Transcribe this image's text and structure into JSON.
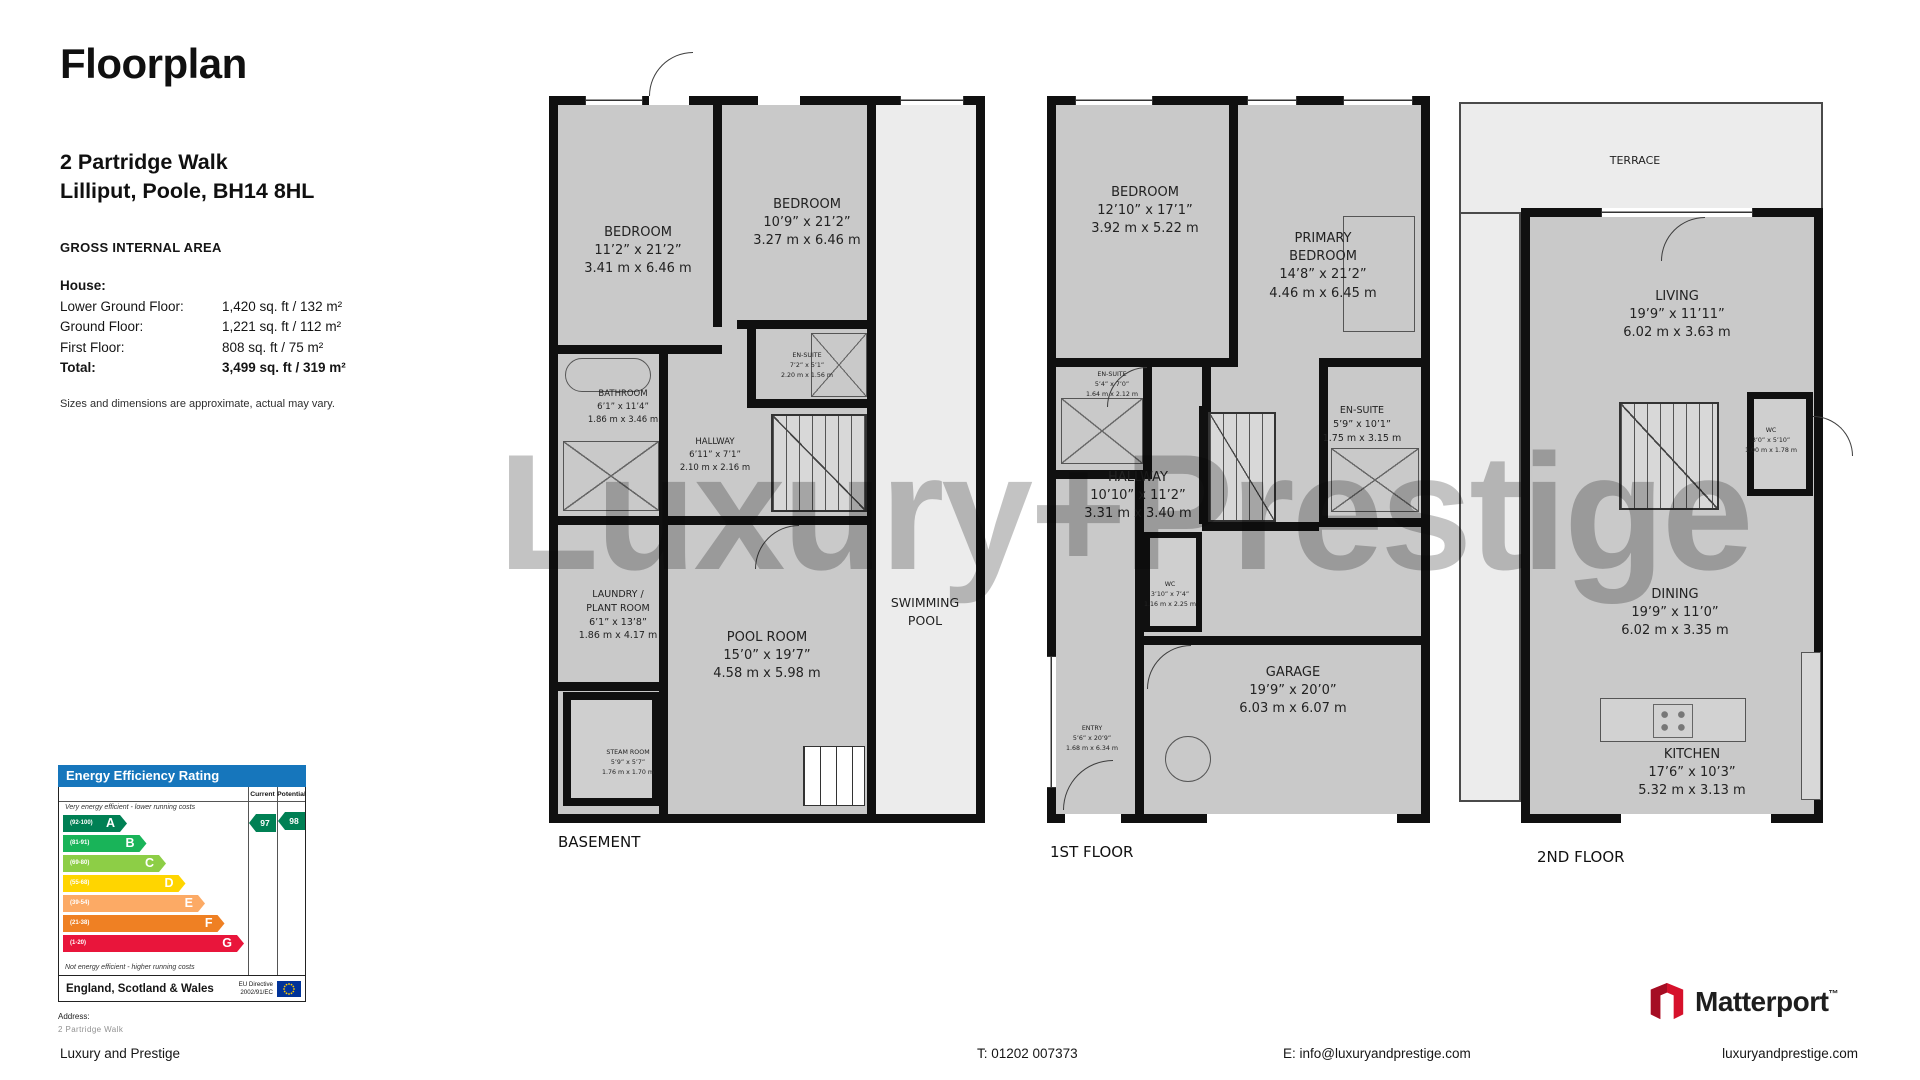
{
  "header": {
    "title": "Floorplan",
    "address_line1": "2 Partridge Walk",
    "address_line2": "Lilliput, Poole, BH14 8HL"
  },
  "gia": {
    "heading": "GROSS INTERNAL AREA",
    "rows": [
      {
        "label": "House:",
        "value": ""
      },
      {
        "label": "Lower Ground Floor:",
        "value": "1,420 sq. ft / 132 m²"
      },
      {
        "label": "Ground Floor:",
        "value": "1,221 sq. ft / 112 m²"
      },
      {
        "label": "First Floor:",
        "value": "808 sq. ft / 75 m²"
      },
      {
        "label": "Total:",
        "value": "3,499 sq. ft / 319 m²"
      }
    ],
    "disclaimer": "Sizes and dimensions are approximate, actual may vary."
  },
  "watermark": "Luxury+Prestige",
  "floors": {
    "basement": {
      "label": "BASEMENT",
      "rooms": {
        "bedroom1": {
          "name": "BEDROOM",
          "imperial": "11’2” x 21’2”",
          "metric": "3.41 m x 6.46 m"
        },
        "bedroom2": {
          "name": "BEDROOM",
          "imperial": "10’9” x 21’2”",
          "metric": "3.27 m x 6.46 m"
        },
        "bathroom": {
          "name": "BATHROOM",
          "imperial": "6’1” x 11’4”",
          "metric": "1.86 m x 3.46 m"
        },
        "hallway": {
          "name": "HALLWAY",
          "imperial": "6’11” x 7’1”",
          "metric": "2.10 m x 2.16 m"
        },
        "ensuite": {
          "name": "EN-SUITE",
          "imperial": "7’2” x 5’1”",
          "metric": "2.20 m x 1.56 m"
        },
        "laundry": {
          "name": "LAUNDRY /\nPLANT ROOM",
          "imperial": "6’1” x 13’8”",
          "metric": "1.86 m x 4.17 m"
        },
        "pool_room": {
          "name": "POOL ROOM",
          "imperial": "15’0” x 19’7”",
          "metric": "4.58 m x 5.98 m"
        },
        "steam_room": {
          "name": "STEAM ROOM",
          "imperial": "5’9” x 5’7”",
          "metric": "1.76 m x 1.70 m"
        },
        "swimming_pool": {
          "name": "SWIMMING\nPOOL"
        }
      }
    },
    "first": {
      "label": "1ST FLOOR",
      "rooms": {
        "bedroom": {
          "name": "BEDROOM",
          "imperial": "12’10” x 17’1”",
          "metric": "3.92 m x 5.22 m"
        },
        "primary": {
          "name": "PRIMARY\nBEDROOM",
          "imperial": "14’8” x 21’2”",
          "metric": "4.46 m x 6.45 m"
        },
        "ensuite_left": {
          "name": "EN-SUITE",
          "imperial": "5’4” x 7’0”",
          "metric": "1.64 m x 2.12 m"
        },
        "hallway": {
          "name": "HALLWAY",
          "imperial": "10’10” x 11’2”",
          "metric": "3.31 m x 3.40 m"
        },
        "ensuite_right": {
          "name": "EN-SUITE",
          "imperial": "5’9” x 10’1”",
          "metric": "1.75 m x 3.15 m"
        },
        "wc": {
          "name": "WC",
          "imperial": "3’10” x 7’4”",
          "metric": "1.16 m x 2.25 m"
        },
        "entry": {
          "name": "ENTRY",
          "imperial": "5’6” x 20’9”",
          "metric": "1.68 m x 6.34 m"
        },
        "garage": {
          "name": "GARAGE",
          "imperial": "19’9” x 20’0”",
          "metric": "6.03 m x 6.07 m"
        }
      }
    },
    "second": {
      "label": "2ND FLOOR",
      "rooms": {
        "terrace": {
          "name": "TERRACE"
        },
        "living": {
          "name": "LIVING",
          "imperial": "19’9” x 11’11”",
          "metric": "6.02 m x 3.63 m"
        },
        "wc": {
          "name": "WC",
          "imperial": "3’0” x 5’10”",
          "metric": "1.00 m x 1.78 m"
        },
        "dining": {
          "name": "DINING",
          "imperial": "19’9” x 11’0”",
          "metric": "6.02 m x 3.35 m"
        },
        "kitchen": {
          "name": "KITCHEN",
          "imperial": "17’6” x 10’3”",
          "metric": "5.32 m x 3.13 m"
        }
      }
    }
  },
  "epc": {
    "title": "Energy Efficiency Rating",
    "header_color": "#1676bc",
    "columns": {
      "current": "Current",
      "potential": "Potential"
    },
    "top_note": "Very energy efficient - lower running costs",
    "bottom_note": "Not energy efficient - higher running costs",
    "bands": [
      {
        "range": "(92-100)",
        "letter": "A",
        "color": "#008054"
      },
      {
        "range": "(81-91)",
        "letter": "B",
        "color": "#19b459"
      },
      {
        "range": "(69-80)",
        "letter": "C",
        "color": "#8dce46"
      },
      {
        "range": "(55-68)",
        "letter": "D",
        "color": "#ffd500"
      },
      {
        "range": "(39-54)",
        "letter": "E",
        "color": "#fcaa65"
      },
      {
        "range": "(21-38)",
        "letter": "F",
        "color": "#ef8023"
      },
      {
        "range": "(1-20)",
        "letter": "G",
        "color": "#e9153b"
      }
    ],
    "current_value": "97",
    "potential_value": "98",
    "arrow_color": "#008054",
    "region": "England, Scotland & Wales",
    "directive": "EU Directive\n2002/91/EC",
    "address_label": "Address:",
    "address_value": "2 Partridge Walk"
  },
  "footer": {
    "company": "Luxury and Prestige",
    "phone": "T: 01202 007373",
    "email": "E: info@luxuryandprestige.com",
    "website": "luxuryandprestige.com",
    "matterport": "Matterport",
    "matterport_tm": "™"
  }
}
